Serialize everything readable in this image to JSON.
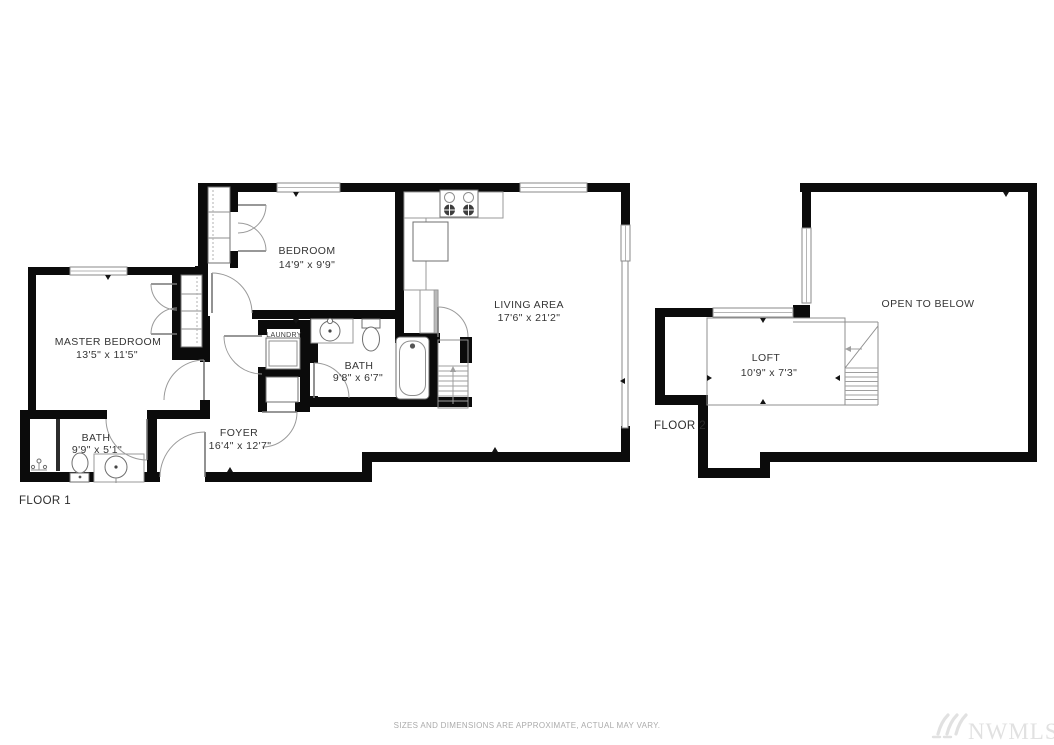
{
  "floor1": {
    "label": "FLOOR 1",
    "rooms": {
      "master": {
        "name": "MASTER BEDROOM",
        "dims": "13'5\" x 11'5\""
      },
      "bedroom": {
        "name": "BEDROOM",
        "dims": "14'9\" x 9'9\""
      },
      "living": {
        "name": "LIVING AREA",
        "dims": "17'6\" x 21'2\""
      },
      "bath_main": {
        "name": "BATH",
        "dims": "9'8\" x 6'7\""
      },
      "bath_master": {
        "name": "BATH",
        "dims": "9'9\" x 5'1\""
      },
      "foyer": {
        "name": "FOYER",
        "dims": "16'4\" x 12'7\""
      },
      "laundry": {
        "name": "LAUNDRY"
      }
    }
  },
  "floor2": {
    "label": "FLOOR 2",
    "rooms": {
      "loft": {
        "name": "LOFT",
        "dims": "10'9\" x 7'3\""
      },
      "open_to_below": {
        "name": "OPEN TO BELOW"
      }
    }
  },
  "footer": {
    "disclaimer": "SIZES AND DIMENSIONS ARE APPROXIMATE, ACTUAL MAY VARY.",
    "watermark": "NWMLS"
  },
  "colors": {
    "wall": "#0b0b0b",
    "thin_line": "#8f8f8f",
    "text": "#353535",
    "disclaimer": "#ababab",
    "watermark": "#e1e1e1"
  }
}
